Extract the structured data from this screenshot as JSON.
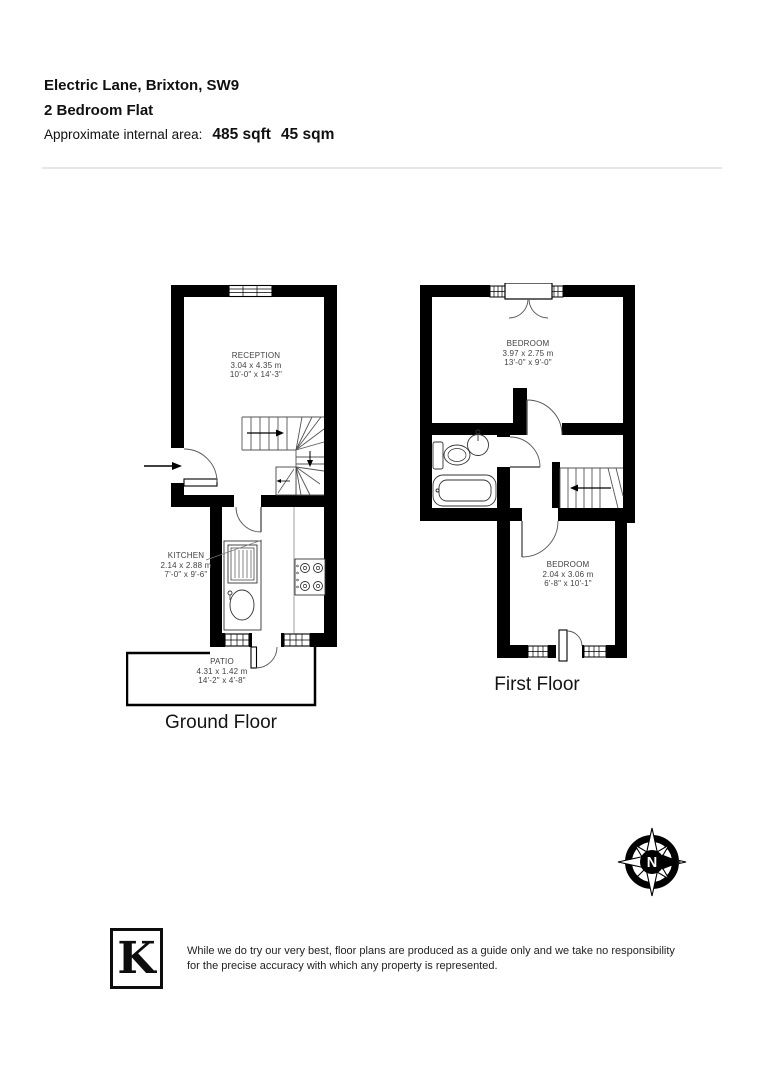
{
  "header": {
    "address": "Electric Lane, Brixton, SW9",
    "property_type": "2 Bedroom Flat",
    "area_label": "Approximate internal area:",
    "area_sqft": "485 sqft",
    "area_sqm": "45 sqm"
  },
  "plans": {
    "ground": {
      "label": "Ground Floor",
      "reception": {
        "name": "RECEPTION",
        "metric": "3.04 x 4.35 m",
        "imperial": "10'-0\" x 14'-3\""
      },
      "kitchen": {
        "name": "KITCHEN",
        "metric": "2.14 x 2.88 m",
        "imperial": "7'-0\" x 9'-6\""
      },
      "patio": {
        "name": "PATIO",
        "metric": "4.31 x 1.42 m",
        "imperial": "14'-2\" x 4'-8\""
      }
    },
    "first": {
      "label": "First Floor",
      "bedroom1": {
        "name": "BEDROOM",
        "metric": "3.97 x 2.75 m",
        "imperial": "13'-0\" x 9'-0\""
      },
      "bedroom2": {
        "name": "BEDROOM",
        "metric": "2.04 x 3.06 m",
        "imperial": "6'-8\" x 10'-1\""
      }
    }
  },
  "compass": {
    "label": "N"
  },
  "logo": {
    "letter": "K"
  },
  "disclaimer": {
    "line1": "While we do try our very best, floor plans are produced as a guide only and we take no responsibility",
    "line2": "for the precise accuracy with which any property is represented."
  },
  "colors": {
    "wall": "#000000",
    "divider": "#e6e6e6",
    "label_text": "#3f3f3f"
  }
}
